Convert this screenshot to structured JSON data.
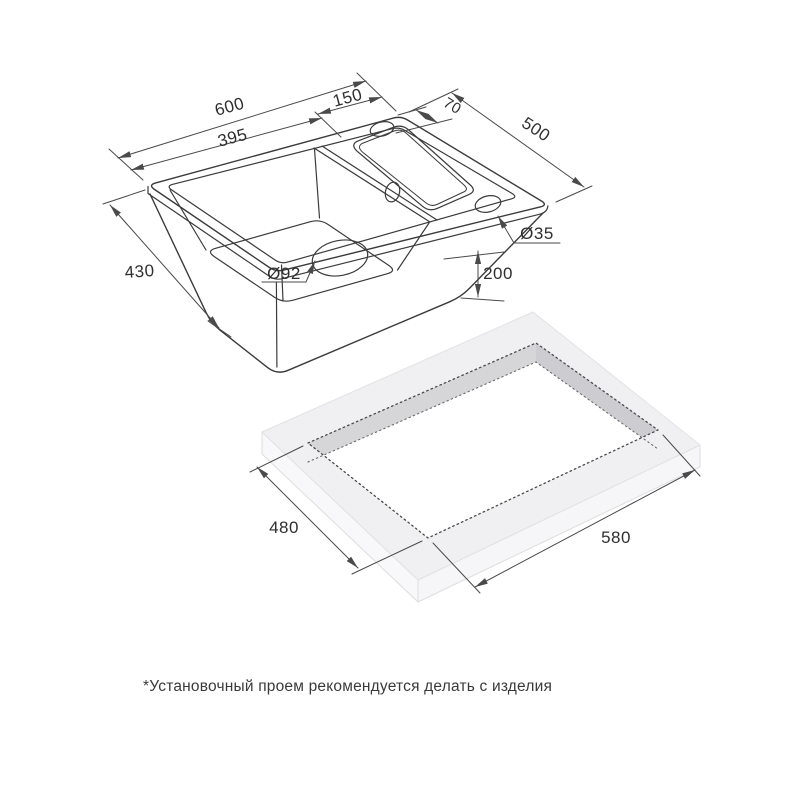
{
  "sink": {
    "dims": {
      "total_width": "600",
      "bowl_width": "395",
      "wing_width": "150",
      "tap_offset": "70",
      "total_depth": "500",
      "bowl_depth": "430",
      "height": "200",
      "drain": "Ø92",
      "tap_hole": "Ø35"
    }
  },
  "cutout": {
    "depth": "480",
    "width": "580"
  },
  "note": {
    "text": "*Установочный проем рекомендуется делать с изделия"
  },
  "colors": {
    "line": "#3b3b3b",
    "dimension": "#4a4a4a",
    "countertop_top": "#f0f0f2",
    "countertop_side": "#f8f8fa",
    "countertop_wall": "#d6d6d9",
    "background": "#ffffff"
  }
}
